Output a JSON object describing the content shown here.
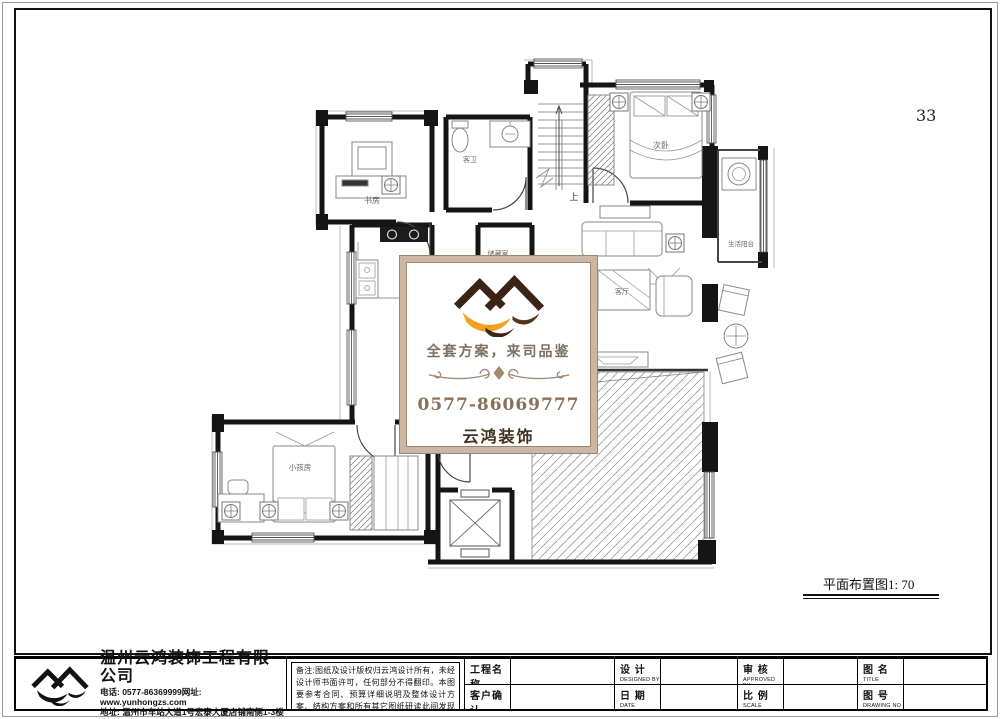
{
  "page": {
    "number": "33",
    "caption": "平面布置图1: 70"
  },
  "plan": {
    "rooms": {
      "study": "书房",
      "guest_bath": "客卫",
      "storage": "储藏室",
      "secondary_bedroom": "次卧",
      "living_room": "客厅",
      "service_balcony": "生活阳台",
      "kids_room": "小孩房",
      "stair_up": "上"
    }
  },
  "watermark": {
    "slogan": "全套方案，来司品鉴",
    "phone": "0577-86069777",
    "brand": "云鸿装饰",
    "colors": {
      "gold": "#f0a21e",
      "dark_brown": "#3c2414",
      "slogan_text": "#7d6e60",
      "phone_text": "#8a7056",
      "frame": "#cbb7a3"
    }
  },
  "title_block": {
    "company": {
      "name": "温州云鸿装饰工程有限公司",
      "phone_line": "电话: 0577-86369999网址: www.yunhongzs.com",
      "address_line": "地址: 温州市车站大道1号宏泰大厦店铺南侧1-3楼"
    },
    "notes": "备注:图纸及设计版权归云鸿设计所有，未经设计师书面许可，任何部分不得翻印。本图要参考合同、预算详细说明及整体设计方案、结构方案和所有其它图纸研读此间发现任何差异，请立即通知设计师。",
    "fields": [
      {
        "cn": "工程名称",
        "en": "PROJECT",
        "value": ""
      },
      {
        "cn": "客户确认",
        "en": "CONFIRM",
        "value": ""
      },
      {
        "cn": "设 计",
        "en": "DESIGNED BY",
        "value": ""
      },
      {
        "cn": "日 期",
        "en": "DATE",
        "value": ""
      },
      {
        "cn": "审 核",
        "en": "APPROVED BY",
        "value": ""
      },
      {
        "cn": "比 例",
        "en": "SCALE",
        "value": ""
      },
      {
        "cn": "图 名",
        "en": "TITLE",
        "value": ""
      },
      {
        "cn": "图 号",
        "en": "DRAWING NO",
        "value": ""
      }
    ]
  }
}
